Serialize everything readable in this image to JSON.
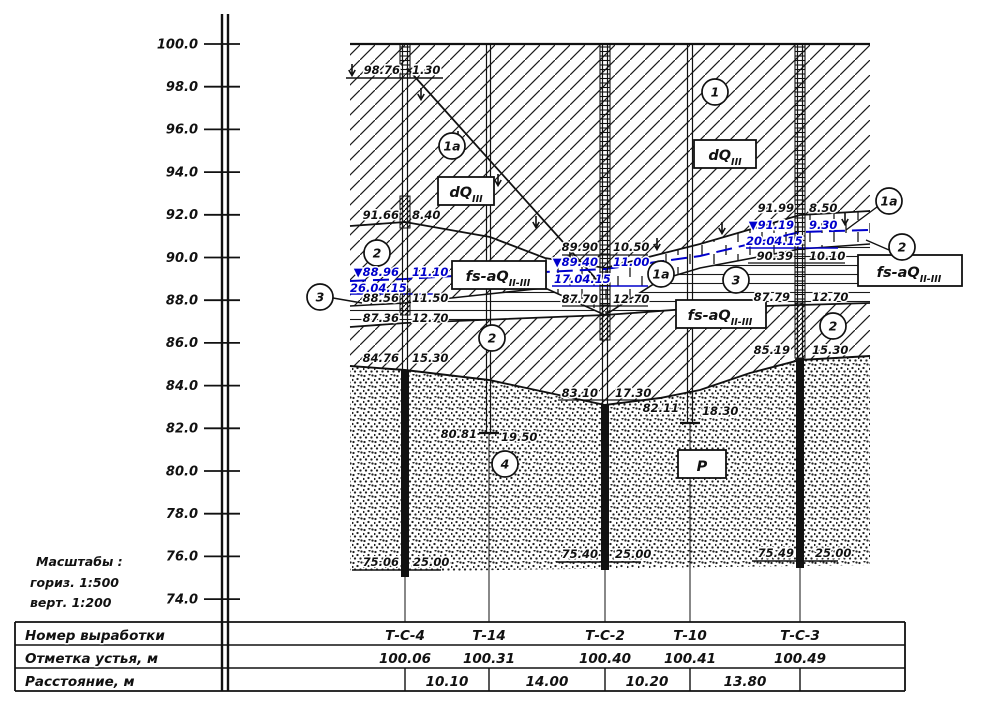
{
  "colors": {
    "water_blue": "#0000cc",
    "ink": "#111111"
  },
  "scales": {
    "title": "Масштабы :",
    "horiz": "гориз. 1:500",
    "vert": "верт. 1:200"
  },
  "axis": {
    "ticks": [
      "100.0",
      "98.0",
      "96.0",
      "94.0",
      "92.0",
      "90.0",
      "88.0",
      "86.0",
      "84.0",
      "82.0",
      "80.0",
      "78.0",
      "76.0",
      "74.0"
    ]
  },
  "legend": {
    "c1": "1",
    "c1a": "1a",
    "c2": "2",
    "c3": "3",
    "c4": "4"
  },
  "strata": {
    "dq": "dQ",
    "dq_sub": "III",
    "fs": "fs-aQ",
    "fs_sub": "II-III",
    "p": "Р"
  },
  "bh": {
    "tc4": {
      "surf_elev": "98.76",
      "surf_depth": "1.30",
      "e1": "91.66",
      "d1": "8.40",
      "wl": "▼88.96",
      "wld": "11.10",
      "wdate": "26.04.15",
      "e2": "88.56",
      "d2": "11.50",
      "e3": "87.36",
      "d3": "12.70",
      "e4": "84.76",
      "d4": "15.30",
      "e5": "75.06",
      "d5": "25.00"
    },
    "t14": {
      "e": "80.81",
      "d": "19.50"
    },
    "tc2": {
      "e1": "89.90",
      "d1": "10.50",
      "wl": "▼89.40",
      "wld": "11.00",
      "wdate": "17.04.15",
      "e2": "87.70",
      "d2": "12.70",
      "e3": "83.10",
      "d3": "17.30",
      "e4": "75.40",
      "d4": "25.00"
    },
    "t10": {
      "e": "82.11",
      "d": "18.30"
    },
    "tc3": {
      "e1": "91.99",
      "d1": "8.50",
      "wl": "▼91.19",
      "wld": "9.30",
      "wdate": "20.04.15",
      "e2": "90.39",
      "d2": "10.10",
      "e3": "87.79",
      "d3": "12.70",
      "e4": "85.19",
      "d4": "15.30",
      "e5": "75.49",
      "d5": "25.00"
    }
  },
  "table": {
    "row_labels": [
      "Номер выработки",
      "Отметка устья, м",
      "Расстояние, м"
    ],
    "names": [
      "Т-С-4",
      "Т-14",
      "Т-С-2",
      "Т-10",
      "Т-С-3"
    ],
    "mouths": [
      "100.06",
      "100.31",
      "100.40",
      "100.41",
      "100.49"
    ],
    "distances": [
      "10.10",
      "14.00",
      "10.20",
      "13.80"
    ]
  }
}
